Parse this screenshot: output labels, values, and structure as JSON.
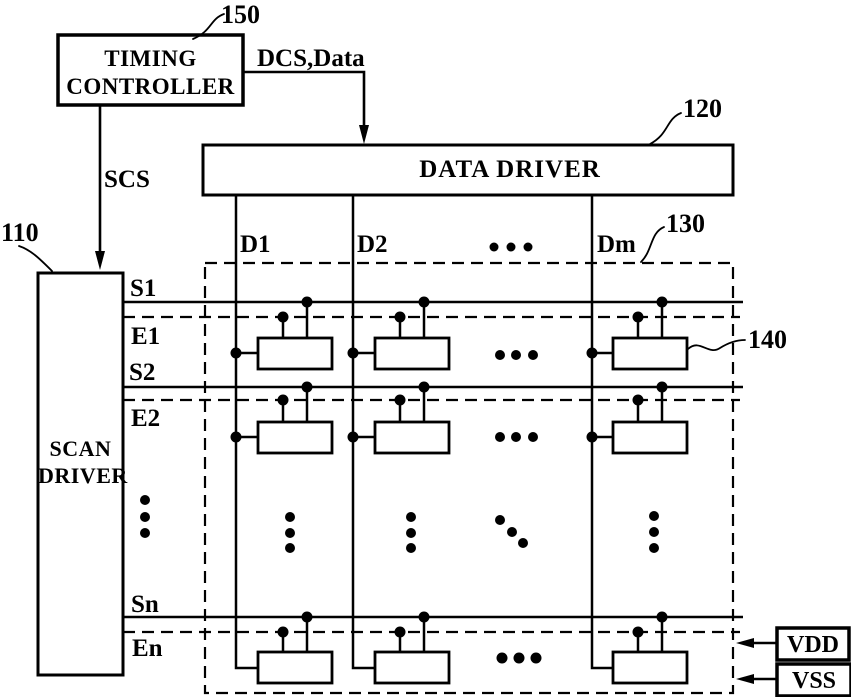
{
  "figure": {
    "timing_controller": {
      "line1": "TIMING",
      "line2": "CONTROLLER",
      "ref": "150"
    },
    "data_driver": {
      "label": "DATA DRIVER",
      "ref": "120"
    },
    "scan_driver": {
      "line1": "SCAN",
      "line2": "DRIVER",
      "ref": "110"
    },
    "pixel_array_ref": "130",
    "pixel_ref": "140",
    "signals": {
      "dcs_data": "DCS,Data",
      "scs": "SCS"
    },
    "data_lines": {
      "d1": "D1",
      "d2": "D2",
      "dm": "Dm"
    },
    "scan_lines": {
      "s1": "S1",
      "e1": "E1",
      "s2": "S2",
      "e2": "E2",
      "sn": "Sn",
      "en": "En"
    },
    "power": {
      "vdd": "VDD",
      "vss": "VSS"
    },
    "colors": {
      "ink": "#000000",
      "paper": "#ffffff"
    }
  }
}
